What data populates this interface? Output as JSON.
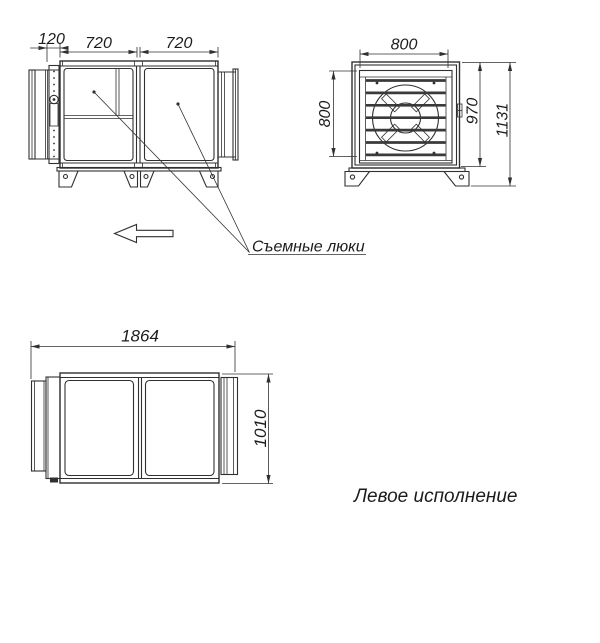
{
  "side_view": {
    "dims": {
      "inlet_depth": "120",
      "section_1_width": "720",
      "section_2_width": "720"
    }
  },
  "front_view": {
    "dims": {
      "opening_width": "800",
      "opening_height": "800",
      "body_height": "970",
      "overall_height": "1131"
    }
  },
  "top_view": {
    "dims": {
      "overall_length": "1864",
      "overall_width": "1010"
    }
  },
  "labels": {
    "removable_hatches": "Съемные люки",
    "configuration": "Левое исполнение"
  },
  "icons": {
    "airflow_arrow": "left-pointing-outline-arrow"
  },
  "colors": {
    "line": "#303030",
    "text": "#1c1c1c",
    "background": "#ffffff"
  }
}
